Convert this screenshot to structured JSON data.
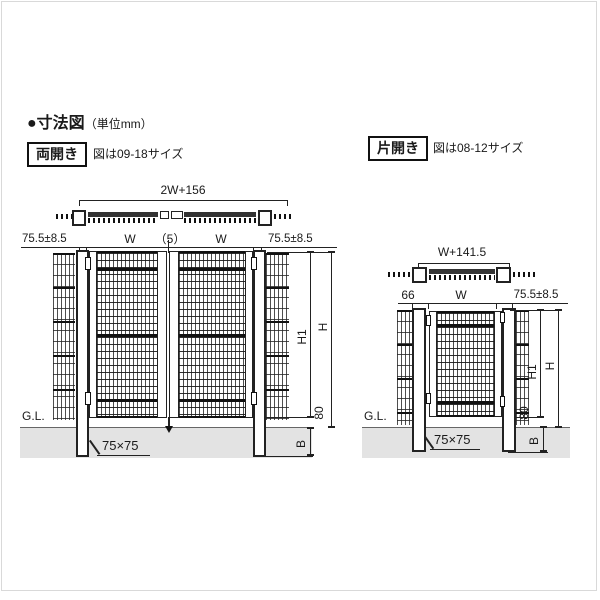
{
  "title": {
    "bullet": "●",
    "text": "寸法図",
    "unit": "（単位mm）"
  },
  "left_diagram": {
    "variant": "両開き",
    "note": "図は09-18サイズ",
    "top_dim": "2W+156",
    "row": [
      "75.5±8.5",
      "W",
      "（5）",
      "W",
      "75.5±8.5"
    ],
    "height_inner": "H1",
    "height_total": "H",
    "bottom_gap": "80",
    "embed_depth": "B",
    "ground": "G.L.",
    "post_size": "75×75"
  },
  "right_diagram": {
    "variant": "片開き",
    "note": "図は08-12サイズ",
    "top_dim": "W+141.5",
    "row": [
      "66",
      "W",
      "75.5±8.5"
    ],
    "height_inner": "H1",
    "height_total": "H",
    "bottom_gap": "80",
    "embed_depth": "B",
    "ground": "G.L.",
    "post_size": "75×75"
  }
}
